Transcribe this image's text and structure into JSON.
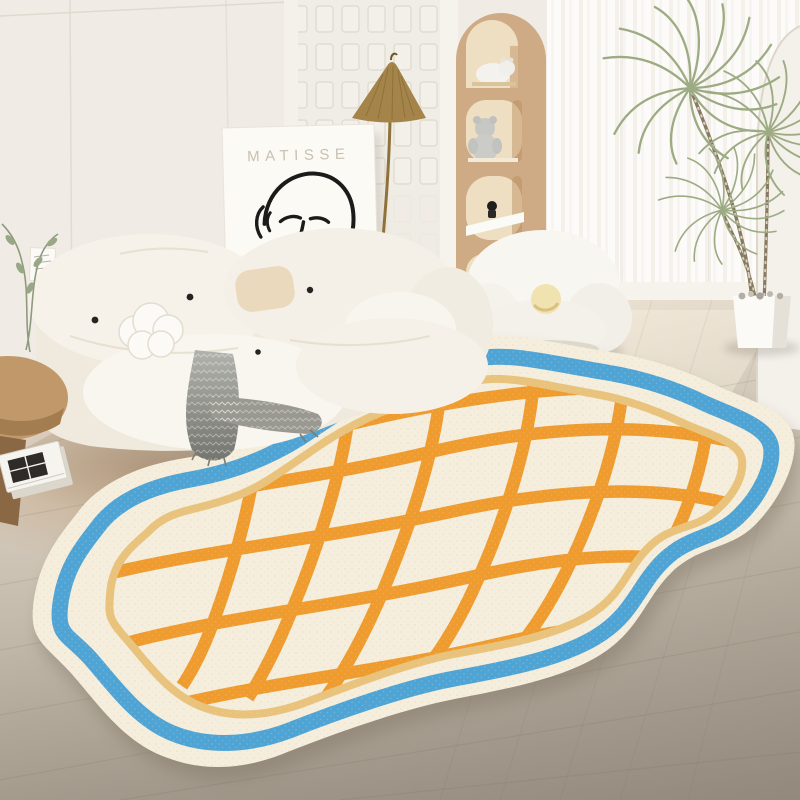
{
  "scene": {
    "description": "bright living room with cream cloud sofa, Matisse line-art poster, brass floor lamp, arched toy shelf, sheer curtained window, dracaena plant and an irregular cloud-shaped rug with blue border and wavy orange grid",
    "poster": {
      "text": "MATISSE"
    },
    "colors": {
      "wall": "#f0ece5",
      "wall_bright": "#fbfaf6",
      "panel_line": "#e1dbd0",
      "niche": "#d8b48e",
      "niche_inner": "#efdfc2",
      "lamp_brass": "#a5844a",
      "sofa": "#f6f2e9",
      "sofa_shadow": "#ddd6c8",
      "throw_gray": "#96968f",
      "rug_base": "#f5eedd",
      "rug_blue": "#4fa4d6",
      "rug_tan": "#e9c37c",
      "rug_orange": "#ef9b2e",
      "plant_green": "#9dab83",
      "stool_wood": "#c0986a",
      "floor_light": "#e8dfd0",
      "floor_dark": "#aba192"
    }
  }
}
